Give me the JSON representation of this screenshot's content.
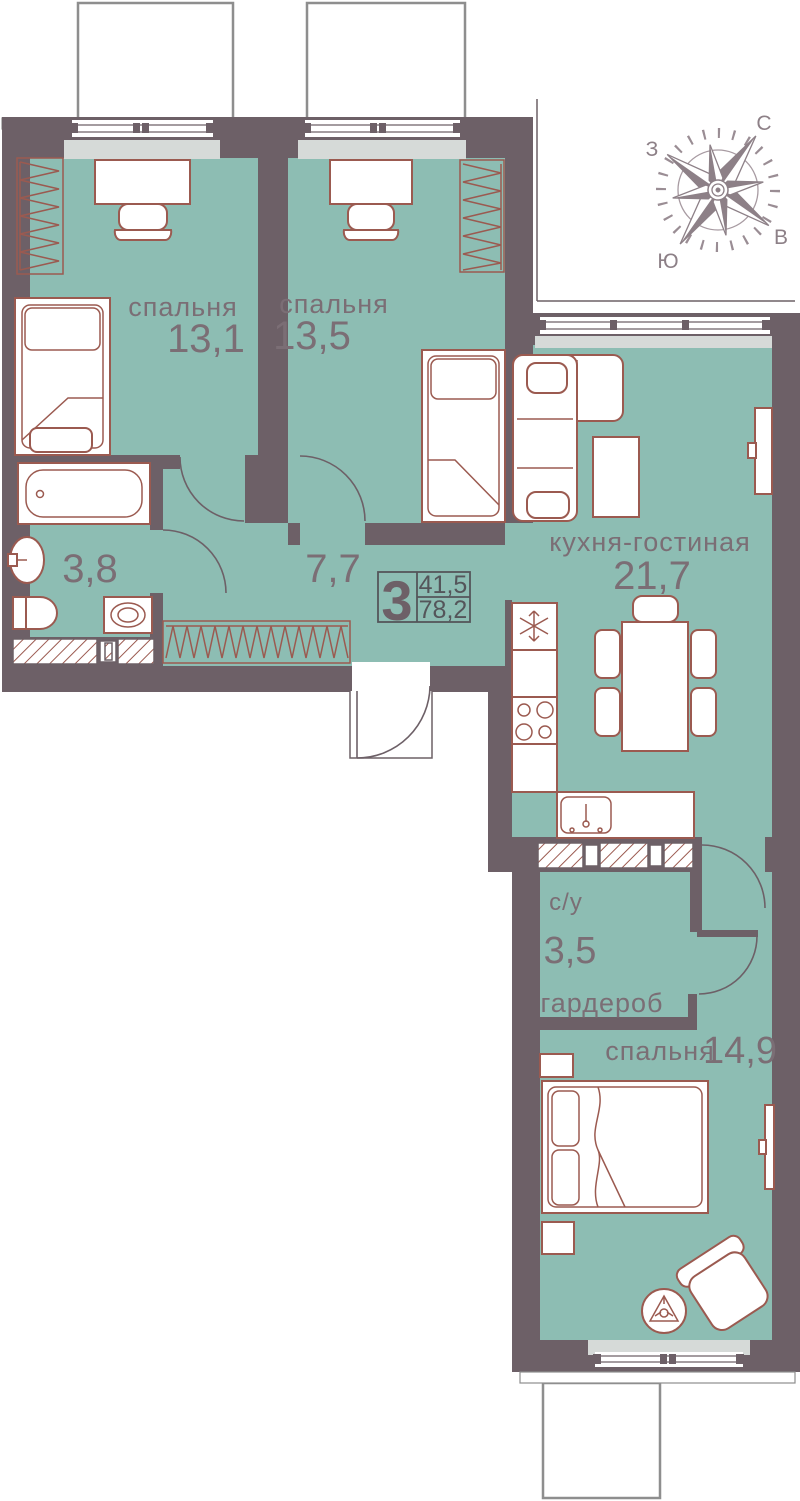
{
  "plan": {
    "rooms": [
      {
        "id": "bedroom-1",
        "name": "спальня",
        "area": "13,1"
      },
      {
        "id": "bedroom-2",
        "name": "спальня",
        "area": "13,5"
      },
      {
        "id": "hallway",
        "name": "",
        "area": "7,7"
      },
      {
        "id": "bathroom",
        "name": "",
        "area": "3,8"
      },
      {
        "id": "kitchen-living",
        "name": "кухня-гостиная",
        "area": "21,7"
      },
      {
        "id": "su",
        "name": "с/у",
        "area": "3,5"
      },
      {
        "id": "wardrobe-room",
        "name": "гардероб",
        "area": ""
      },
      {
        "id": "bedroom-3",
        "name": "спальня",
        "area": "14,9"
      }
    ],
    "badge": {
      "rooms_count": "3",
      "area_living": "41,5",
      "area_total": "78,2"
    },
    "compass": {
      "north": "С",
      "east": "В",
      "south": "Ю",
      "west": "З"
    },
    "colors": {
      "floor": "#8dbdb3",
      "wall": "#6d6067",
      "furniture_outline": "#9b5a50",
      "window_sill": "#d6dad8",
      "label_text": "#7b6e75",
      "badge_text": "#54555a",
      "compass": "#8d8087"
    }
  }
}
